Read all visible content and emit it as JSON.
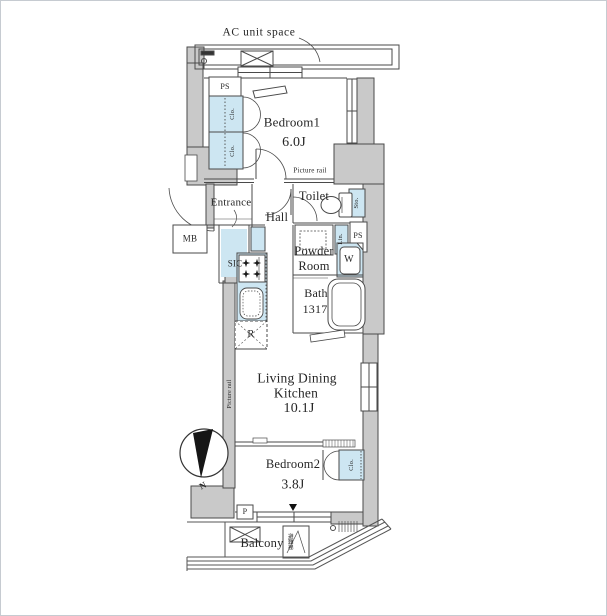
{
  "floor_plan": {
    "labels": {
      "ac_unit_space": "AC unit space",
      "ps_top": "PS",
      "clo1a": "Clo.",
      "clo1b": "Clo.",
      "bedroom1": "Bedroom1",
      "bedroom1_size": "6.0J",
      "picture_rail_top": "Picture rail",
      "entrance": "Entrance",
      "mb": "MB",
      "sic": "SIC",
      "hall": "Hall",
      "toilet": "Toilet",
      "sto": "Sto.",
      "lin": "Lin.",
      "ps_right": "PS",
      "powder_line1": "Powder",
      "powder_line2": "Room",
      "washer": "W",
      "bath": "Bath",
      "bath_size": "1317",
      "fridge": "R",
      "ldk_line1": "Living Dining",
      "ldk_line2": "Kitchen",
      "ldk_size": "10.1J",
      "picture_rail_left": "Picture rail",
      "compass_n": "N",
      "bedroom2": "Bedroom2",
      "bedroom2_size": "3.8J",
      "clo2": "Clo.",
      "p": "P",
      "balcony": "Balcony",
      "evac_hatch": "避難梯"
    },
    "colors": {
      "wall_gray": "#c9c9c9",
      "fixture_blue": "#cde6f2",
      "line": "#4a4a4a",
      "text": "#262626"
    }
  }
}
